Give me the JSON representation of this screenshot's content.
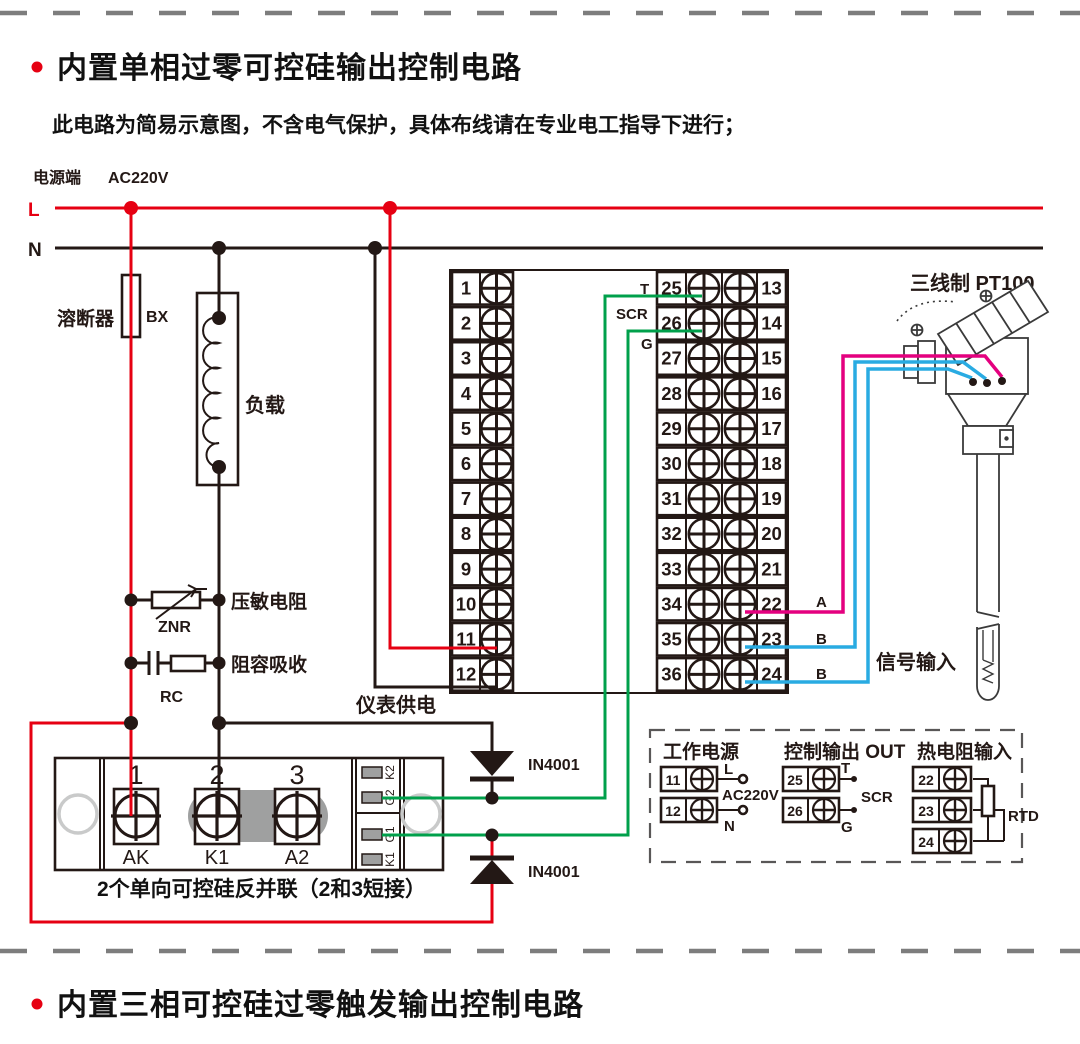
{
  "section1": {
    "title": "内置单相过零可控硅输出控制电路",
    "subtitle": "此电路为简易示意图，不含电气保护，具体布线请在专业电工指导下进行；"
  },
  "section2": {
    "title": "内置三相可控硅过零触发输出控制电路"
  },
  "power": {
    "label": "电源端",
    "voltage": "AC220V",
    "line_l": "L",
    "line_n": "N"
  },
  "components": {
    "fuse_label": "溶断器",
    "fuse_code": "BX",
    "load_label": "负载",
    "varistor_label": "压敏电阻",
    "varistor_code": "ZNR",
    "rc_label": "阻容吸收",
    "rc_code": "RC",
    "meter_supply": "仪表供电",
    "diode_top": "IN4001",
    "diode_bottom": "IN4001",
    "scr_caption": "2个单向可控硅反并联（2和3短接）"
  },
  "outputs": {
    "t": "T",
    "scr": "SCR",
    "g": "G"
  },
  "terminal_blocks": {
    "left": {
      "numbers": [
        "1",
        "2",
        "3",
        "4",
        "5",
        "6",
        "7",
        "8",
        "9",
        "10",
        "11",
        "12"
      ]
    },
    "right_inner": {
      "numbers": [
        "25",
        "26",
        "27",
        "28",
        "29",
        "30",
        "31",
        "32",
        "33",
        "34",
        "35",
        "36"
      ]
    },
    "right_outer": {
      "numbers": [
        "13",
        "14",
        "15",
        "16",
        "17",
        "18",
        "19",
        "20",
        "21",
        "22",
        "23",
        "24"
      ]
    }
  },
  "scr_module": {
    "terminals": [
      "1",
      "2",
      "3"
    ],
    "terminal_names": [
      "AK",
      "K1",
      "A2"
    ],
    "pins": [
      "K2",
      "G2",
      "G1",
      "K1"
    ]
  },
  "sensor": {
    "title": "三线制 PT100",
    "wire_a": "A",
    "wire_b1": "B",
    "wire_b2": "B",
    "signal": "信号输入"
  },
  "legend": {
    "power": {
      "title": "工作电源",
      "t11": "11",
      "t12": "12",
      "l": "L",
      "n": "N",
      "voltage": "AC220V"
    },
    "output": {
      "title": "控制输出 OUT",
      "t25": "25",
      "t26": "26",
      "t": "T",
      "scr": "SCR",
      "g": "G"
    },
    "rtd": {
      "title": "热电阻输入",
      "t22": "22",
      "t23": "23",
      "t24": "24",
      "label": "RTD"
    }
  },
  "colors": {
    "line_red": "#E60012",
    "line_green": "#00A04B",
    "line_magenta": "#E4007F",
    "line_blue": "#29ABE2",
    "line_dark": "#231815",
    "strap_gray": "#9FA0A0"
  }
}
